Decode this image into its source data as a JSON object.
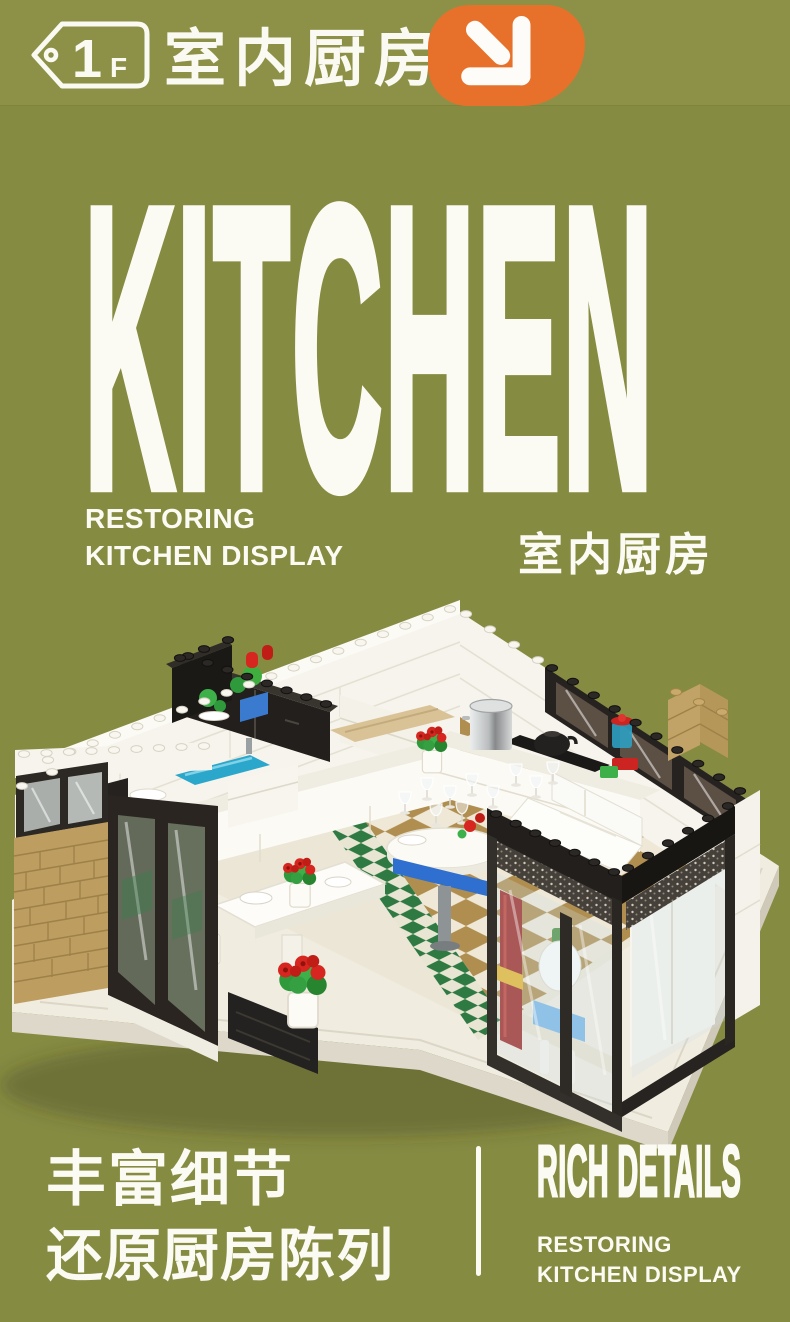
{
  "page": {
    "bg_color": "#868b42",
    "header_band_color": "#8d9148",
    "text_color": "#fbfaf3",
    "accent_orange": "#e7712a"
  },
  "header": {
    "floor_tag": {
      "number": "1",
      "suffix": "F",
      "icon": "price-tag-icon"
    },
    "title_zh": "室内厨房",
    "arrow_icon": "arrow-down-right"
  },
  "hero": {
    "title": "KITCHEN",
    "subtitle_en_line1": "RESTORING",
    "subtitle_en_line2": "KITCHEN DISPLAY",
    "subtitle_zh": "室内厨房"
  },
  "model": {
    "description": "Isometric building-block model of an indoor kitchen: white brick walls, black upper cabinets, counter with pot and kettle, blue sink, dining table and round table with glass goblets, red potted flowers, white sofa, tan brick wall and dark-framed glass display walls on a cream baseplate with tan checkerboard floor",
    "colors": {
      "baseplate": "#f0ece0",
      "wall_white": "#f6f4ec",
      "cabinet_black": "#24211d",
      "tan_brick": "#bd9d60",
      "floor_tan": "#b08e50",
      "floor_cream": "#efe8d7",
      "tile_green": "#2f7a43",
      "flower_red": "#d6261f",
      "leaf_green": "#2f9a3c",
      "frame_dark": "#2e2a25",
      "water_blue": "#2ba7cc",
      "table_blue": "#2f6fd0"
    }
  },
  "footer": {
    "zh_line1": "丰富细节",
    "zh_line2": "还原厨房陈列",
    "en_title": "RICH DETAILS",
    "en_sub_line1": "RESTORING",
    "en_sub_line2": "KITCHEN DISPLAY"
  }
}
